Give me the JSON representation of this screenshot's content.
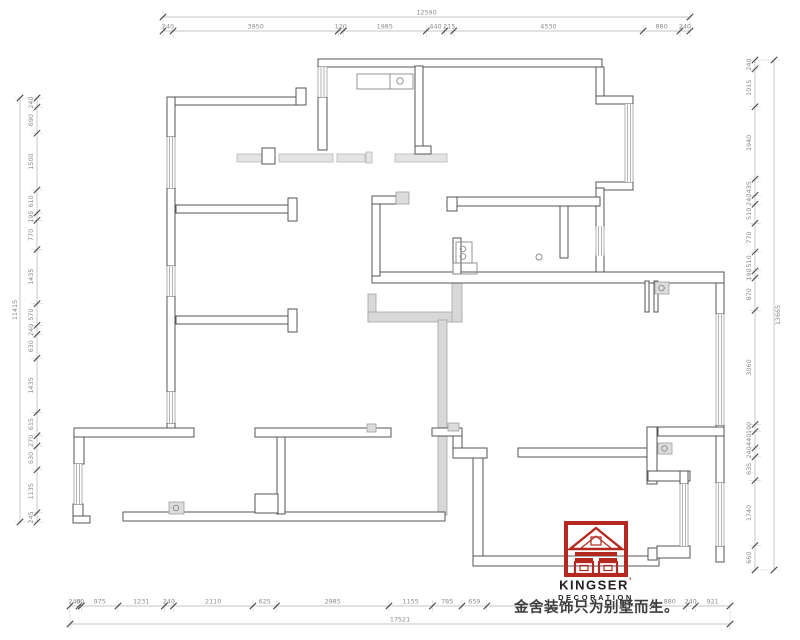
{
  "branding": {
    "brand_name": "KINGSER",
    "brand_mark": "’",
    "brand_sub": "DECORATION",
    "brand_color": "#b5281f",
    "tagline": "金舍装饰只为别墅而生。"
  },
  "dimensions": {
    "top": {
      "total": "12590",
      "segments": [
        "240",
        "3950",
        "120",
        "1985",
        "440",
        "215",
        "4530",
        "880",
        "240"
      ]
    },
    "bottom": {
      "total": "17521",
      "segments": [
        "240",
        "60",
        "975",
        "1231",
        "240",
        "2110",
        "625",
        "2985",
        "1155",
        "785",
        "659",
        "",
        "880",
        "240",
        "921"
      ]
    },
    "left": {
      "total": "11415",
      "segments": [
        "240",
        "690",
        "1500",
        "610",
        "195",
        "770",
        "1435",
        "570",
        "240",
        "630",
        "1435",
        "615",
        "270",
        "630",
        "1135",
        "245"
      ]
    },
    "right": {
      "total": "13665",
      "segments": [
        "240",
        "1015",
        "1940",
        "435",
        "240",
        "510",
        "770",
        "510",
        "190",
        "870",
        "3060",
        "190",
        "440",
        "240",
        "635",
        "1740",
        "660"
      ]
    }
  }
}
